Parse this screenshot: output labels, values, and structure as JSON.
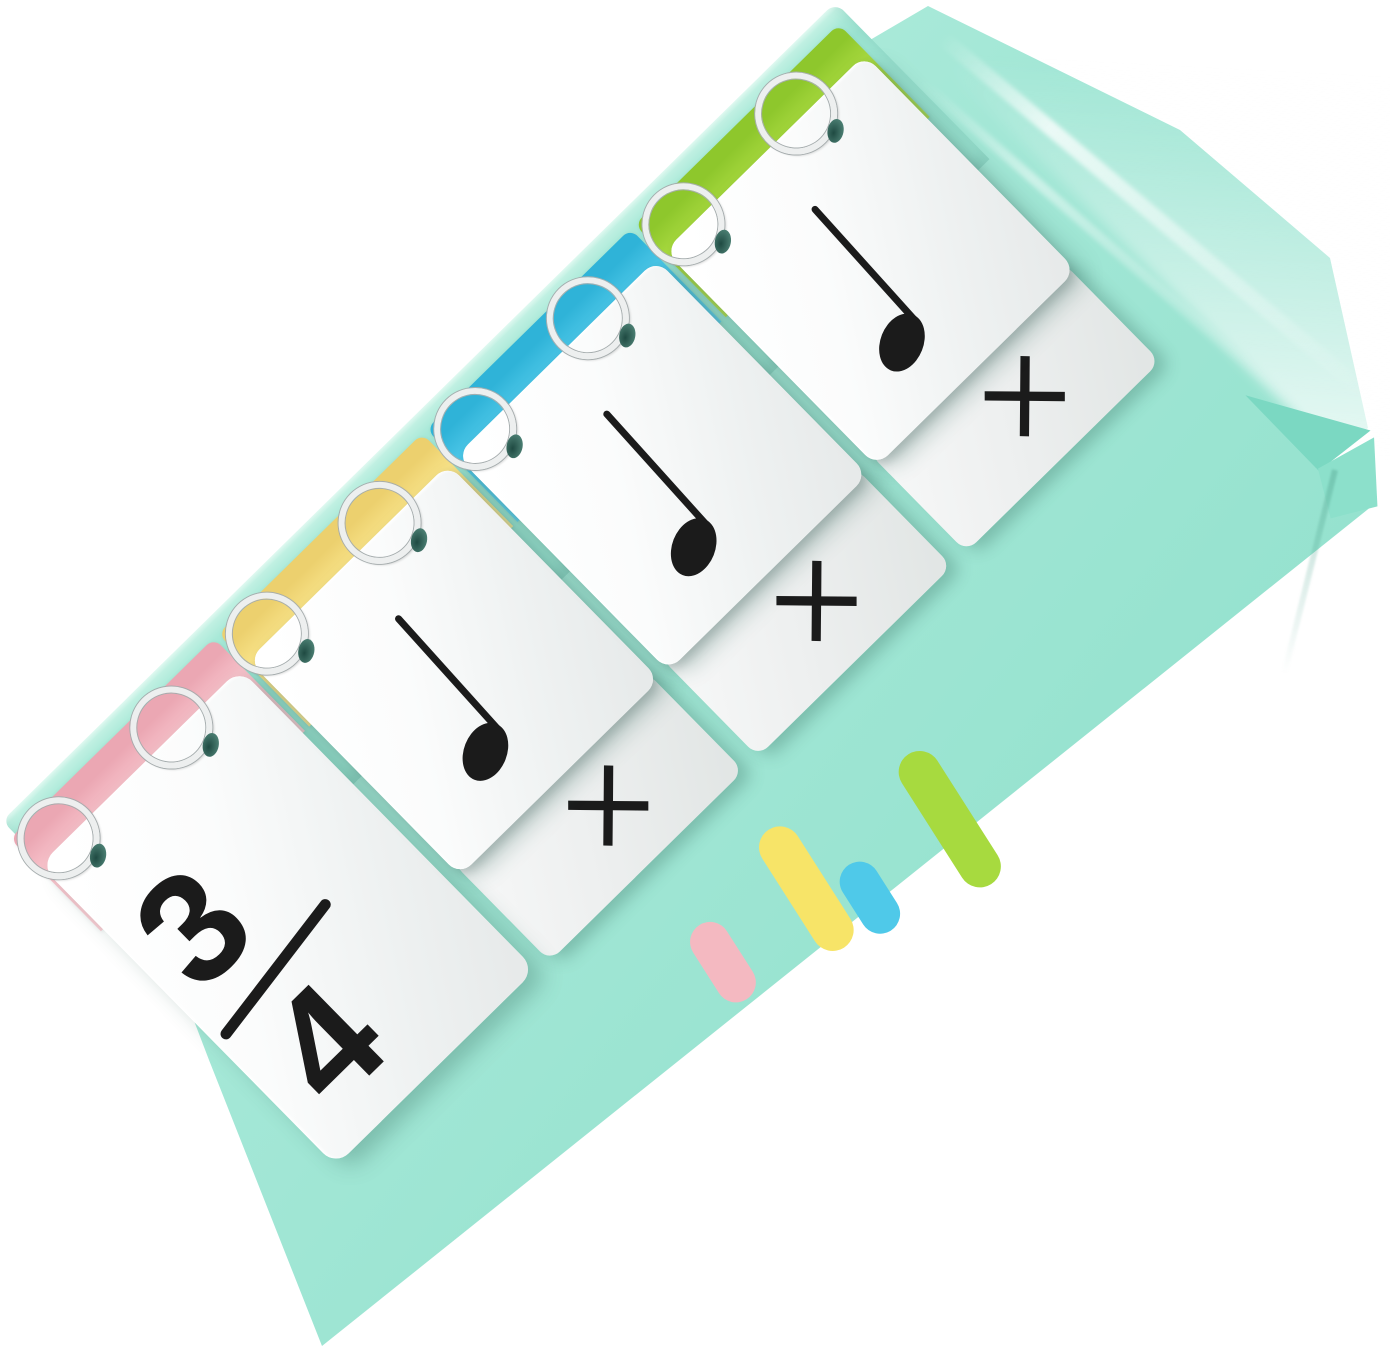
{
  "colors": {
    "background": "#FFFFFF",
    "base_mint": "#A3E7D6",
    "base_mint_light": "#B4EEDD",
    "base_mint_dark": "#8FE0CB",
    "fold_dark": "#7BD8C2",
    "ink": "#1B1B1B",
    "ring_silver": "#EDEFEF",
    "ring_outline": "#A6ADAE",
    "hole_shadow": "#497C70",
    "tab_pink": "#F6BFC8",
    "tab_yellow": "#F7E186",
    "tab_blue": "#49C5E6",
    "tab_green": "#A5D73D",
    "dash_pink": "#F4B9C1",
    "dash_yellow": "#F7E468",
    "dash_blue": "#4FC9E9",
    "dash_green": "#A7DA3F"
  },
  "flipchart": {
    "description": "spiral-bound rhythm flash cards on mint easel stand",
    "rings_per_card": 2,
    "ring_count": 8,
    "cards": [
      {
        "type": "time-signature",
        "numerator": "3",
        "denominator": "4",
        "tab": "pink"
      },
      {
        "type": "note-card",
        "note": "quarter-note",
        "corner_symbol": "×",
        "tab": "yellow"
      },
      {
        "type": "note-card",
        "note": "quarter-note",
        "corner_symbol": "×",
        "tab": "blue"
      },
      {
        "type": "note-card",
        "note": "quarter-note",
        "corner_symbol": "×",
        "tab": "green"
      }
    ]
  },
  "base": {
    "dashes": [
      {
        "color": "pink",
        "length": "short"
      },
      {
        "color": "yellow",
        "length": "long"
      },
      {
        "color": "blue",
        "length": "short"
      },
      {
        "color": "green",
        "length": "long"
      }
    ]
  }
}
